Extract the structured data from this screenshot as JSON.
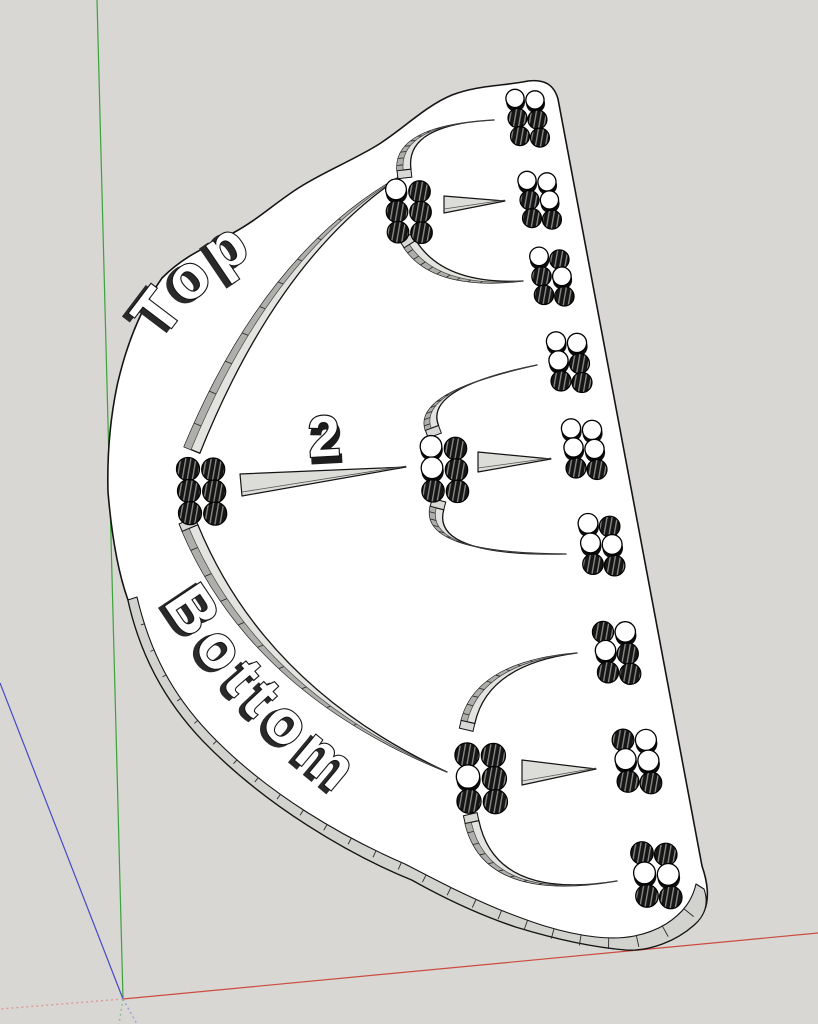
{
  "scene": {
    "app": "3d-viewport",
    "background_color": "#d8d7d3",
    "axes": {
      "green": {
        "solid_color": "#3ca23c",
        "dotted_color": "#86c286"
      },
      "red": {
        "solid_color": "#cc4b40",
        "dotted_color": "#de9a93"
      },
      "blue": {
        "solid_color": "#4848cb",
        "dotted_color": "#9e9ed8"
      }
    },
    "board": {
      "face_color": "#ffffff",
      "outline_color": "#141414",
      "edge_band_color": "#d2d2ce",
      "slot_floor_color": "#e3e3df",
      "slot_wall_color": "#aeaeaa",
      "cap_color": "#d8d8d4",
      "pointer_color": "#dcdcd8",
      "peg_dark_color": "#161616",
      "peg_hatch_line_color": "#8e8e8a",
      "labels": {
        "top": "Top",
        "bottom": "Bottom",
        "number": "2"
      }
    },
    "clusters": [
      {
        "id": "root",
        "kind": "node",
        "x": 188,
        "y": 469,
        "s": 1.05,
        "pattern": [
          "DD",
          "DD",
          "DD"
        ]
      },
      {
        "id": "node-top",
        "kind": "node",
        "x": 396,
        "y": 191,
        "s": 0.98,
        "pattern": [
          "WD",
          "DD",
          "DD"
        ]
      },
      {
        "id": "node-mid",
        "kind": "node",
        "x": 431,
        "y": 448,
        "s": 1.02,
        "pattern": [
          "WD",
          "WD",
          "DD"
        ]
      },
      {
        "id": "node-bottom",
        "kind": "node",
        "x": 467,
        "y": 755,
        "s": 1.1,
        "pattern": [
          "DD",
          "WD",
          "DD"
        ]
      },
      {
        "id": "leaf-1",
        "kind": "leaf",
        "x": 515,
        "y": 100,
        "s": 0.95,
        "pattern": [
          "WW",
          "DD",
          "DD"
        ]
      },
      {
        "id": "leaf-2",
        "kind": "leaf",
        "x": 527,
        "y": 182,
        "s": 0.95,
        "pattern": [
          "WW",
          "DW",
          "DD"
        ]
      },
      {
        "id": "leaf-3",
        "kind": "leaf",
        "x": 539,
        "y": 258,
        "s": 0.97,
        "pattern": [
          "WD",
          "DW",
          "DD"
        ]
      },
      {
        "id": "leaf-4",
        "kind": "leaf",
        "x": 556,
        "y": 343,
        "s": 1.0,
        "pattern": [
          "WW",
          "WD",
          "DD"
        ]
      },
      {
        "id": "leaf-5",
        "kind": "leaf",
        "x": 571,
        "y": 430,
        "s": 1.0,
        "pattern": [
          "WW",
          "WW",
          "DD"
        ]
      },
      {
        "id": "leaf-6",
        "kind": "leaf",
        "x": 588,
        "y": 525,
        "s": 1.03,
        "pattern": [
          "WD",
          "WW",
          "DD"
        ]
      },
      {
        "id": "leaf-7",
        "kind": "leaf",
        "x": 603,
        "y": 632,
        "s": 1.06,
        "pattern": [
          "DW",
          "WD",
          "DD"
        ]
      },
      {
        "id": "leaf-8",
        "kind": "leaf",
        "x": 623,
        "y": 740,
        "s": 1.09,
        "pattern": [
          "DW",
          "WW",
          "DD"
        ]
      },
      {
        "id": "leaf-9",
        "kind": "leaf",
        "x": 642,
        "y": 853,
        "s": 1.13,
        "pattern": [
          "DD",
          "WW",
          "DD"
        ]
      }
    ],
    "arc_slots": [
      {
        "id": "arc-root-top",
        "p0": [
          192,
          450
        ],
        "c": [
          274,
          249
        ],
        "p1": [
          408,
          172
        ],
        "w": 17,
        "cap": false
      },
      {
        "id": "arc-root-bottom",
        "p0": [
          190,
          528
        ],
        "c": [
          258,
          690
        ],
        "p1": [
          447,
          772
        ],
        "w": 17,
        "cap": true
      },
      {
        "id": "arc-top-up",
        "p0": [
          404,
          170
        ],
        "c": [
          399,
          125
        ],
        "p1": [
          494,
          120
        ],
        "w": 14,
        "cap": true
      },
      {
        "id": "arc-top-down",
        "p0": [
          410,
          244
        ],
        "c": [
          438,
          288
        ],
        "p1": [
          523,
          281
        ],
        "w": 14,
        "cap": true
      },
      {
        "id": "arc-mid-up",
        "p0": [
          432,
          428
        ],
        "c": [
          418,
          390
        ],
        "p1": [
          537,
          365
        ],
        "w": 14,
        "cap": true
      },
      {
        "id": "arc-mid-down",
        "p0": [
          437,
          508
        ],
        "c": [
          425,
          555
        ],
        "p1": [
          566,
          554
        ],
        "w": 14,
        "cap": true
      },
      {
        "id": "arc-bottom-up",
        "p0": [
          468,
          722
        ],
        "c": [
          482,
          663
        ],
        "p1": [
          577,
          653
        ],
        "w": 14,
        "cap": true
      },
      {
        "id": "arc-bottom-down",
        "p0": [
          472,
          822
        ],
        "c": [
          490,
          902
        ],
        "p1": [
          617,
          881
        ],
        "w": 14,
        "cap": true
      }
    ],
    "pointer_slots": [
      {
        "id": "pointer-root",
        "base": [
          [
            240,
            474
          ],
          [
            242,
            496
          ]
        ],
        "tip": [
          406,
          467
        ]
      },
      {
        "id": "pointer-top",
        "base": [
          [
            444,
            196
          ],
          [
            444,
            213
          ]
        ],
        "tip": [
          505,
          201
        ]
      },
      {
        "id": "pointer-mid",
        "base": [
          [
            478,
            452
          ],
          [
            478,
            472
          ]
        ],
        "tip": [
          551,
          459
        ]
      },
      {
        "id": "pointer-bottom",
        "base": [
          [
            522,
            760
          ],
          [
            522,
            785
          ]
        ],
        "tip": [
          596,
          769
        ]
      }
    ]
  }
}
